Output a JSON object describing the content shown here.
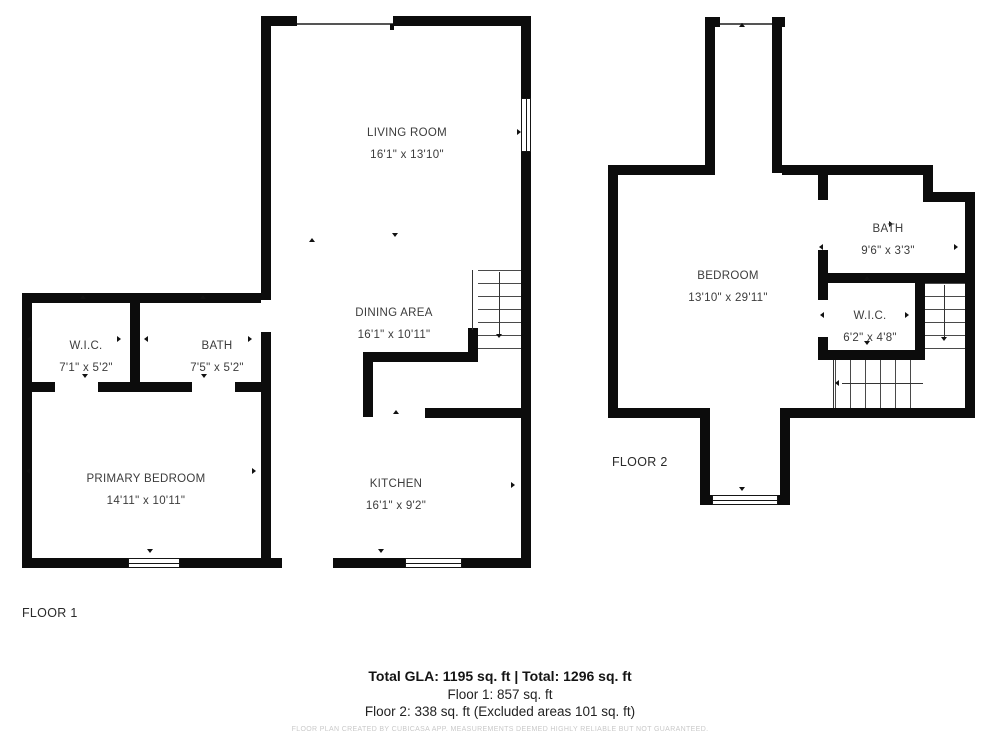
{
  "floors": {
    "floor1": {
      "label": "FLOOR 1"
    },
    "floor2": {
      "label": "FLOOR 2"
    }
  },
  "rooms": {
    "f1_living": {
      "name": "LIVING ROOM",
      "dims": "16'1\" x 13'10\""
    },
    "f1_dining": {
      "name": "DINING AREA",
      "dims": "16'1\" x 10'11\""
    },
    "f1_kitchen": {
      "name": "KITCHEN",
      "dims": "16'1\" x 9'2\""
    },
    "f1_primary": {
      "name": "PRIMARY BEDROOM",
      "dims": "14'11\" x 10'11\""
    },
    "f1_wic": {
      "name": "W.I.C.",
      "dims": "7'1\" x 5'2\""
    },
    "f1_bath": {
      "name": "BATH",
      "dims": "7'5\" x 5'2\""
    },
    "f2_bedroom": {
      "name": "BEDROOM",
      "dims": "13'10\" x 29'11\""
    },
    "f2_bath": {
      "name": "BATH",
      "dims": "9'6\" x 3'3\""
    },
    "f2_wic": {
      "name": "W.I.C.",
      "dims": "6'2\" x 4'8\""
    }
  },
  "summary": {
    "total": "Total GLA: 1195 sq. ft | Total: 1296 sq. ft",
    "floor1": "Floor 1: 857 sq. ft",
    "floor2": "Floor 2: 338 sq. ft (Excluded areas 101 sq. ft)"
  },
  "disclaimer": "FLOOR PLAN CREATED BY CUBICASA APP. MEASUREMENTS DEEMED HIGHLY RELIABLE BUT NOT GUARANTEED.",
  "colors": {
    "wall": "#0c0c0c",
    "label_text": "#3c3c3c",
    "disclaimer_text": "#c9c9c9"
  }
}
